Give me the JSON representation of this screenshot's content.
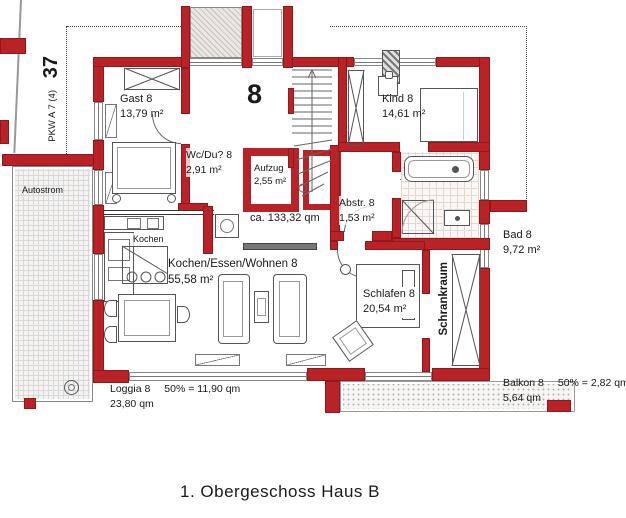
{
  "title": "1. Obergeschoss Haus B",
  "site": {
    "plot_number": "37",
    "parking": "PKW A 7 (4)",
    "outdoor_label": "Autostrom"
  },
  "unit": {
    "number": "8",
    "total_area": "ca. 133,32 qm"
  },
  "rooms": {
    "gast": {
      "name": "Gast 8",
      "area": "13,79 m²"
    },
    "kind": {
      "name": "Kind 8",
      "area": "14,61 m²"
    },
    "wc_du": {
      "name": "Wc/Du? 8",
      "area": "2,91 m²"
    },
    "aufzug": {
      "name": "Aufzug",
      "area": "2,55 m²"
    },
    "abstell": {
      "name": "Abstr. 8",
      "area": "1,53 m²"
    },
    "bad": {
      "name": "Bad 8",
      "area": "9,72 m²"
    },
    "kochen": {
      "name": "Kochen"
    },
    "wohnen": {
      "name": "Kochen/Essen/Wohnen 8",
      "area": "55,58 m²"
    },
    "schlafen": {
      "name": "Schlafen 8",
      "area": "20,54 m²"
    },
    "schrankraum": {
      "name": "Schrankraum"
    }
  },
  "outdoor": {
    "loggia": {
      "name": "Loggia 8",
      "calc": "50% = 11,90 qm",
      "area": "23,80 qm"
    },
    "balkon": {
      "name": "Balkon 8",
      "calc": "50% = 2,82 qm",
      "area": "5,64 qm"
    }
  },
  "colors": {
    "wall": "#b92327"
  }
}
